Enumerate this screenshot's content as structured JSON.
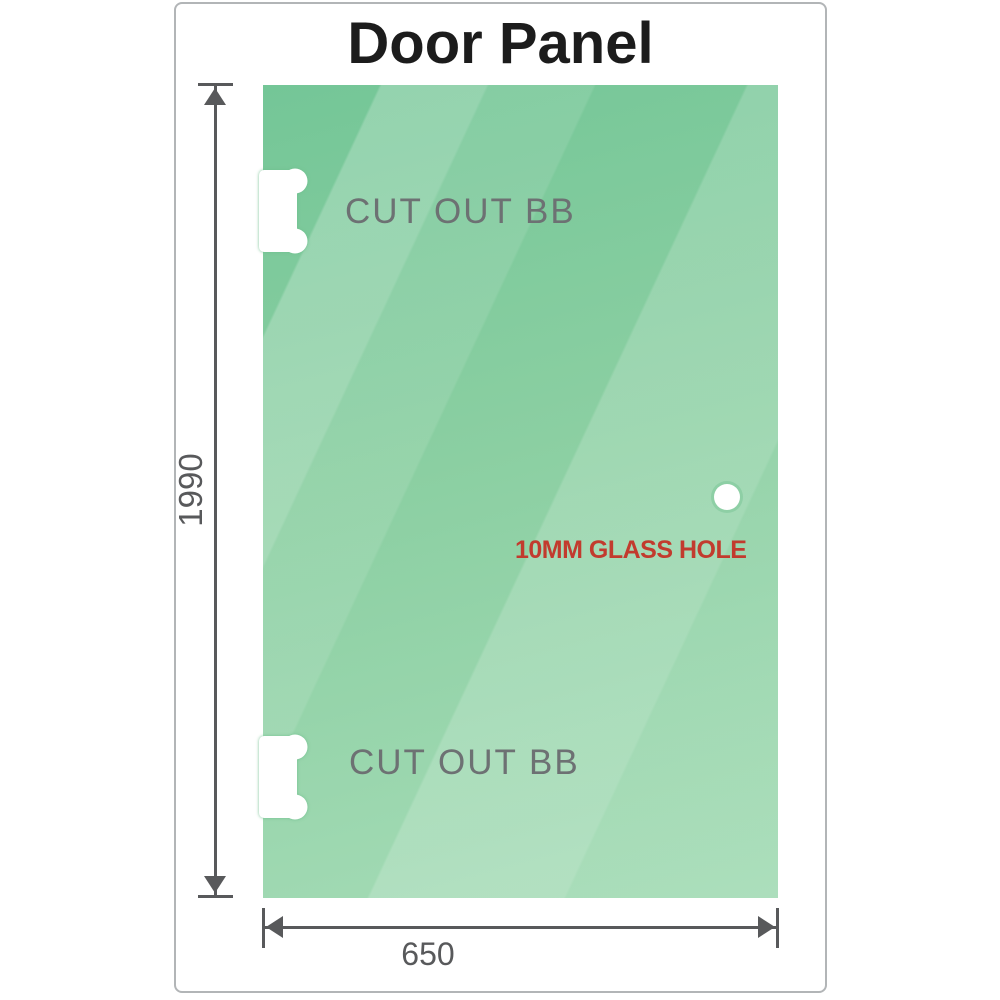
{
  "title": "Door Panel",
  "glass": {
    "cutouts": [
      {
        "label": "CUT OUT BB",
        "position": "top-left-edge"
      },
      {
        "label": "CUT OUT BB",
        "position": "bottom-left-edge"
      }
    ],
    "hole": {
      "label": "10MM GLASS HOLE",
      "position": "right-middle"
    }
  },
  "dimensions": {
    "height": {
      "value": "1990",
      "orientation": "vertical"
    },
    "width": {
      "value": "650",
      "orientation": "horizontal"
    }
  },
  "colors": {
    "title_text": "#1c1c1c",
    "frame_border": "#b2b5b7",
    "glass_dark": "#74c697",
    "glass_base": "#8bcfa2",
    "glass_light": "#a6dcb7",
    "dim_line": "#58595b",
    "cutout_text": "#6d7173",
    "hole_text": "#c23b2e"
  }
}
